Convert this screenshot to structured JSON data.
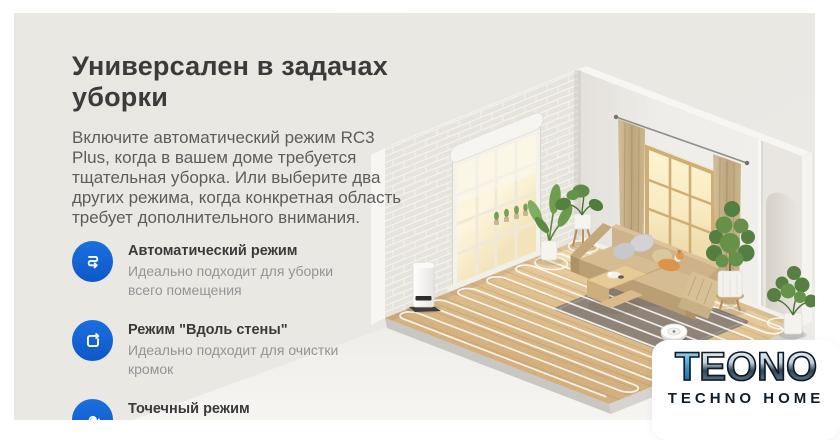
{
  "content": {
    "title": "Универсален в задачах уборки",
    "paragraph": "Включите автоматический режим RC3 Plus, когда в вашем доме требуется тщательная уборка. Или выберите два других режима, когда конкретная область требует дополнительного внимания.",
    "accent_color": "#1465d9",
    "title_color": "#3b3b3b",
    "body_color": "#5d5d5d",
    "features": [
      {
        "icon": "serpentine-route-icon",
        "title": "Автоматический режим",
        "description": "Идеально подходит для уборки всего помещения"
      },
      {
        "icon": "wall-follow-icon",
        "title": "Режим \"Вдоль стены\"",
        "description": "Идеально подходит для очистки кромок"
      },
      {
        "icon": "spiral-spot-icon",
        "title": "Точечный режим",
        "description": "Идеально подходит для очистки от стойких загрязнений"
      }
    ]
  },
  "logo": {
    "brand": "TEONO",
    "brand_initial": "T",
    "brand_rest": "EONO",
    "tagline": "TECHNO HOME",
    "accent_color": "#2e8fd0",
    "brand_color": "#16222e"
  }
}
